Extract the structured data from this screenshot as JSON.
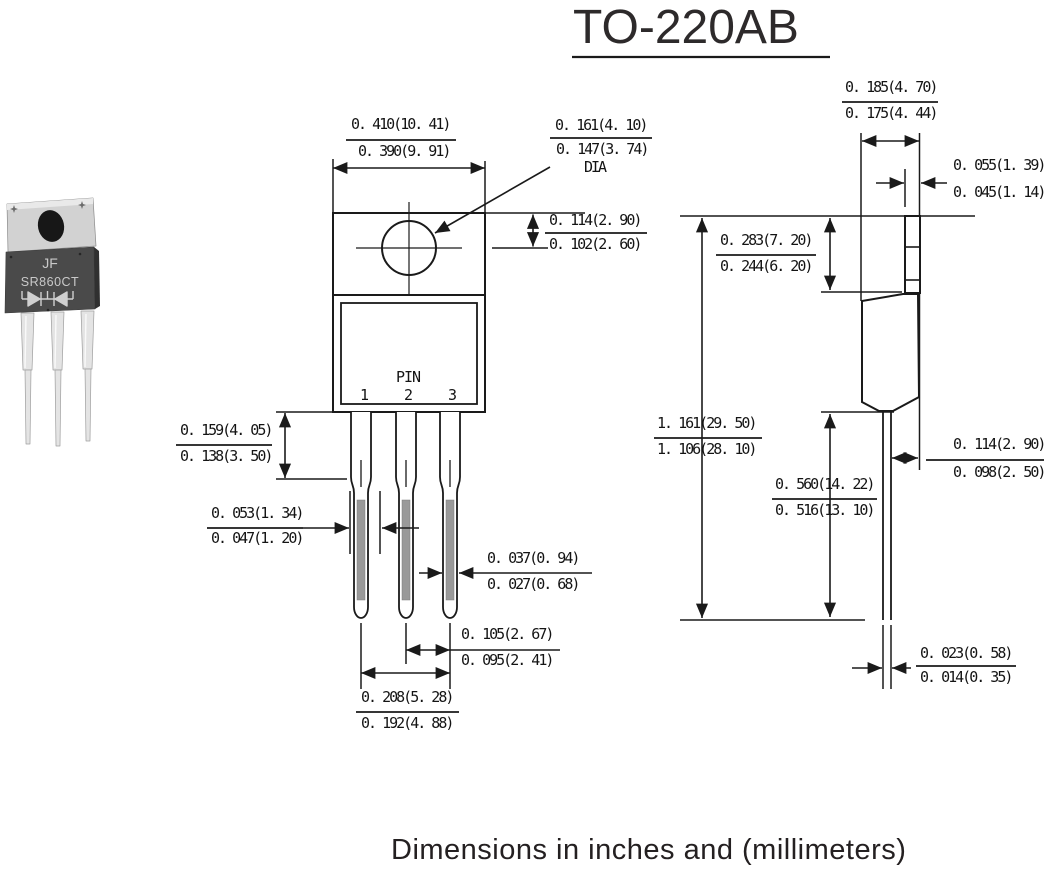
{
  "title": "TO-220AB",
  "caption": "Dimensions in inches and (millimeters)",
  "part_photo": {
    "brand": "JF",
    "part_number": "SR860CT",
    "symbol": "dual-diode-common-cathode"
  },
  "front_view": {
    "pin_label": "PIN",
    "pin1": "1",
    "pin2": "2",
    "pin3": "3",
    "dims": {
      "width": {
        "max": "0. 410(10. 41)",
        "min": "0. 390(9. 91)"
      },
      "hole_dia": {
        "max": "0. 161(4. 10)",
        "min": "0. 147(3. 74)",
        "suffix": "DIA"
      },
      "hole_offset": {
        "max": "0. 114(2. 90)",
        "min": "0. 102(2. 60)"
      },
      "shoulder_length": {
        "max": "0. 159(4. 05)",
        "min": "0. 138(3. 50)"
      },
      "lead_width_upper": {
        "max": "0. 053(1. 34)",
        "min": "0. 047(1. 20)"
      },
      "lead_width_lower": {
        "max": "0. 037(0. 94)",
        "min": "0. 027(0. 68)"
      },
      "lead_pitch": {
        "max": "0. 105(2. 67)",
        "min": "0. 095(2. 41)"
      },
      "lead_span": {
        "max": "0. 208(5. 28)",
        "min": "0. 192(4. 88)"
      }
    }
  },
  "side_view": {
    "dims": {
      "depth": {
        "max": "0. 185(4. 70)",
        "min": "0. 175(4. 44)"
      },
      "tab_thickness": {
        "max": "0. 055(1. 39)",
        "min": "0. 045(1. 14)"
      },
      "tab_height": {
        "max": "0. 283(7. 20)",
        "min": "0. 244(6. 20)"
      },
      "overall_height": {
        "max": "1. 161(29. 50)",
        "min": "1. 106(28. 10)"
      },
      "lead_length": {
        "max": "0. 560(14. 22)",
        "min": "0. 516(13. 10)"
      },
      "body_offset": {
        "max": "0. 114(2. 90)",
        "min": "0. 098(2. 50)"
      },
      "lead_thickness": {
        "max": "0. 023(0. 58)",
        "min": "0. 014(0. 35)"
      }
    }
  },
  "colors": {
    "line": "#1a1a1a",
    "lead_shade": "#999999",
    "photo_body": "#4a4a4a",
    "photo_tab": "#d2d2d2"
  }
}
